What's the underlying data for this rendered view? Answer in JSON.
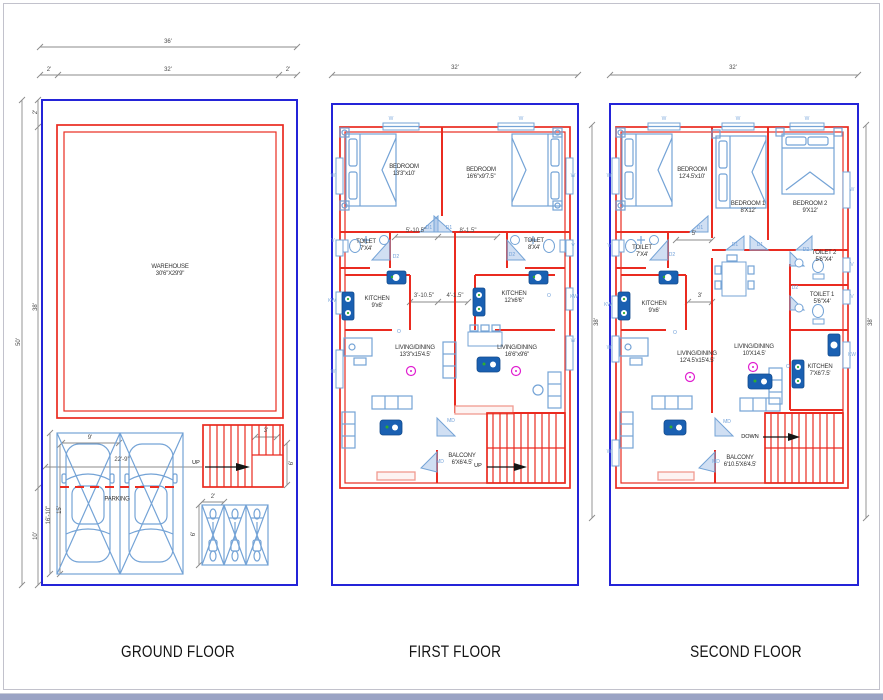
{
  "palette": {
    "boundary_blue": "#2424d8",
    "wall_red": "#ea2b20",
    "furniture_blue": "#74a3d6",
    "fixture_dark_blue": "#1a60b2",
    "fan_magenta": "#e01fd0",
    "dimension_gray": "#8b8b8b"
  },
  "floors": {
    "ground": {
      "title": "GROUND FLOOR",
      "warehouse_name": "WAREHOUSE",
      "warehouse_size": "30'6\"X29'9\"",
      "parking": "PARKING",
      "up": "UP",
      "dim_total_w": "36'",
      "dim_side": "2'",
      "dim_inner_w": "32'",
      "dim_side2": "2'",
      "dim_total_h": "50'",
      "dim_top": "2'",
      "dim_depth": "38'",
      "dim_bottom": "10'",
      "dim_stall": "9'",
      "dim_park_w": "22'-9\"",
      "dim_park_l1": "16'-10\"",
      "dim_park_l2": "15'",
      "dim_stair_w": "3'",
      "dim_stair_l": "6'",
      "dim_bike_w": "2'",
      "dim_bike_l": "6'"
    },
    "first": {
      "title": "FIRST FLOOR",
      "dim_w": "32'",
      "dim_d": "38'",
      "bedroom1_name": "BEDROOM",
      "bedroom1_size": "13'3\"x10'",
      "bedroom2_name": "BEDROOM",
      "bedroom2_size": "16'6\"x9'7.5\"",
      "toilet1_name": "TOILET",
      "toilet1_size": "7'X4'",
      "toilet2_name": "TOILET",
      "toilet2_size": "8'X4'",
      "kitchen1_name": "KITCHEN",
      "kitchen1_size": "9'x6'",
      "kitchen2_name": "KITCHEN",
      "kitchen2_size": "12'x6'6\"",
      "living1_name": "LIVING/DINING",
      "living1_size": "13'3\"x15'4.5'",
      "living2_name": "LIVING/DINING",
      "living2_size": "16'6\"x9'6\"",
      "balcony_name": "BALCONY",
      "balcony_size": "6'X6'4.5'",
      "up": "UP",
      "dim_a": "5'-10.5\"",
      "dim_b": "8'-1.5\"",
      "dim_c": "3'-10.5\"",
      "dim_d2": "4'-1.5\"",
      "door_d1": "D1",
      "door_d2": "D2",
      "door_md": "MD",
      "door_o": "O",
      "win_w": "W",
      "win_v": "V",
      "win_kw": "KW"
    },
    "second": {
      "title": "SECOND FLOOR",
      "dim_w": "32'",
      "dim_d": "38'",
      "bedroom1_name": "BEDROOM",
      "bedroom1_size": "12'4.5'x10'",
      "bedroom2_name": "BEDROOM 1",
      "bedroom2_size": "8'X12'",
      "bedroom3_name": "BEDROOM 2",
      "bedroom3_size": "9'X12'",
      "toilet_l_name": "TOILET",
      "toilet_l_size": "7'X4'",
      "toilet2_name": "TOILET 2",
      "toilet2_size": "5'6\"X4'",
      "toilet1_name": "TOILET 1",
      "toilet1_size": "5'6\"X4'",
      "kitchen_l_name": "KITCHEN",
      "kitchen_l_size": "9'x6'",
      "kitchen_r_name": "KITCHEN",
      "kitchen_r_size": "7'X6'7.5'",
      "living1_name": "LIVING/DINING",
      "living1_size": "12'4.5'x15'4.5'",
      "living2_name": "LIVING/DINING",
      "living2_size": "10'X14.5'",
      "balcony_name": "BALCONY",
      "balcony_size": "6'10.5'X6'4.5'",
      "down": "DOWN",
      "dim_a": "5'",
      "dim_b": "3'",
      "door_d1": "D1",
      "door_d2": "D2",
      "door_md": "MD",
      "door_o": "O",
      "win_w": "W",
      "win_v": "V",
      "win_kw": "KW"
    }
  }
}
